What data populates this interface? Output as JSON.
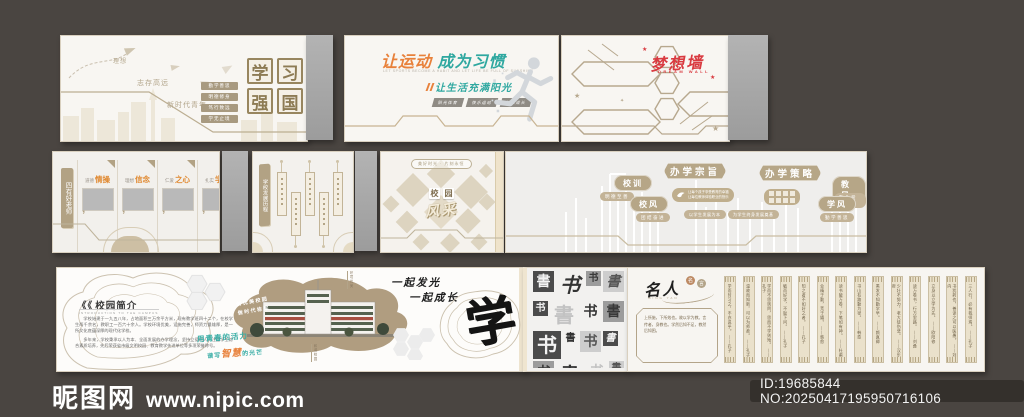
{
  "watermark": {
    "site_name": "昵图网",
    "site_url": "www.nipic.com",
    "id_text": "ID:19685844 NO:20250417195950716106"
  },
  "study": {
    "chars": [
      "学",
      "习",
      "强",
      "国"
    ],
    "label_ideal": "理想",
    "label_motto": "志存高远",
    "label_youth": "新时代青年",
    "tags": [
      "勤学善思",
      "明德修身",
      "笃行致远",
      "学无止境"
    ]
  },
  "sport": {
    "title_orange": "让运动",
    "title_teal": "成为习惯",
    "subtitle_en": "LET SPORTS BECOME A HABIT AND LET LIFE BE FULL OF SUNSHINE",
    "subtitle": "让生活充满阳光",
    "tags": [
      "阳光体育",
      "快乐运动",
      "健康成长"
    ]
  },
  "dream": {
    "title": "梦想墙",
    "subtitle": "DREAM WALL"
  },
  "teachers": {
    "sign": "四有好老师",
    "mark": "’",
    "items": [
      {
        "prefix": "道德",
        "accent": "情操"
      },
      {
        "prefix": "理想",
        "accent": "信念"
      },
      {
        "prefix": "仁爱",
        "accent": "之心"
      },
      {
        "prefix": "扎实",
        "accent": "学识"
      }
    ]
  },
  "history": {
    "sign": "学校发展历程"
  },
  "mosaic": {
    "pill": "美好时光 · 片刻永恒",
    "box1": "校",
    "box2": "园",
    "script": "风采"
  },
  "strategy": {
    "badge1": "办学宗旨",
    "badge2": "办学策略",
    "mission_line1": "让每个孩子享受教育的幸福",
    "mission_line2": "让每位教师体验职业的快乐",
    "pills": [
      "以学生发展为本",
      "为学生终身发展奠基"
    ],
    "ovals": [
      {
        "label": "校训",
        "tag": "明德至善"
      },
      {
        "label": "校风",
        "tag": "团结奋进"
      },
      {
        "label": "教风",
        "tag": "敬业爱生"
      },
      {
        "label": "学风",
        "tag": "勤学善思"
      }
    ]
  },
  "intro": {
    "marks": "《《",
    "heading": "校园简介",
    "heading_en": "INTRODUCTION TO THE CAMPUS",
    "body_p1": "学校始建于一九五八年，占地面积三万余平方米，现有教学班四十二个，在校学生两千余名，教职工一百六十余人。学校环境优美，设施完善，师资力量雄厚，是一所文化底蕴深厚的现代化学校。",
    "body_p2": "多年来，学校秉承以人为本、全面发展的办学理念，坚持立德树人，注重学生综合素质培养，先后荣获省市级文明校园、教育教学先进单位等多项荣誉称号。",
    "blob_line1": "创优美校园",
    "blob_line2": "做时代栋梁",
    "ann1": "环境优美",
    "ann2": "和谐校园",
    "grow1": "一起发光",
    "grow2": "一起成长",
    "slogan1": "用青春的活力",
    "slogan2_pre": "谱写",
    "slogan2_accent": "智慧",
    "slogan2_post": "的光芒",
    "calligraphy": "学"
  },
  "books": {
    "tiles": [
      {
        "c": "書",
        "v": "t-dark",
        "f": "f-serif",
        "s": "s-m"
      },
      {
        "c": "书",
        "v": "t-plain",
        "f": "f-ital",
        "s": "s-l"
      },
      {
        "c": "书",
        "v": "t-mid",
        "f": "f-serif",
        "s": "s-s"
      },
      {
        "c": "書",
        "v": "t-light",
        "f": "f-ital",
        "s": "s-m"
      },
      {
        "c": "书",
        "v": "t-dark",
        "f": "f-sans",
        "s": "s-s"
      },
      {
        "c": "書",
        "v": "t-faint",
        "f": "f-serif",
        "s": "s-l"
      },
      {
        "c": "书",
        "v": "t-plain",
        "f": "f-serif",
        "s": "s-m"
      },
      {
        "c": "書",
        "v": "t-mid",
        "f": "f-serif",
        "s": "s-m"
      },
      {
        "c": "书",
        "v": "t-dark",
        "f": "f-serif",
        "s": "s-l"
      },
      {
        "c": "書",
        "v": "t-plain",
        "f": "f-sans",
        "s": "s-s"
      },
      {
        "c": "书",
        "v": "t-light",
        "f": "f-serif",
        "s": "s-m"
      },
      {
        "c": "書",
        "v": "t-dark",
        "f": "f-ital",
        "s": "s-s"
      },
      {
        "c": "书",
        "v": "t-mid",
        "f": "f-sans",
        "s": "s-m"
      },
      {
        "c": "書",
        "v": "t-plain",
        "f": "f-serif",
        "s": "s-l"
      },
      {
        "c": "书",
        "v": "t-faint",
        "f": "f-serif",
        "s": "s-m"
      },
      {
        "c": "書",
        "v": "t-light",
        "f": "f-sans",
        "s": "s-s"
      },
      {
        "c": "书",
        "v": "t-dark",
        "f": "f-serif",
        "s": "s-m"
      },
      {
        "c": "書",
        "v": "t-plain",
        "f": "f-ital",
        "s": "s-m"
      }
    ]
  },
  "celebrity": {
    "title": "名人",
    "subtitle": "MING YAN",
    "seal1": "名",
    "seal2": "言",
    "quote": "上所施，下所效也。故以学为教。言传者，身教也。学然后知不足，教然后知困。",
    "slats": [
      "学而时习之，不亦说乎。 ——孔子",
      "温故而知新，可以为师矣。 ——孔子",
      "学而不思则罔，思而不学则殆。 ——孔子",
      "敏而好学，不耻下问。 ——孔子",
      "知之者不如好之者。 ——孔子",
      "业精于勤，荒于嬉。 ——韩愈",
      "读书破万卷，下笔如有神。 ——杜甫",
      "书山有路勤为径。 ——韩愈",
      "黑发不知勤学早。 ——颜真卿",
      "少壮不努力，老大徒伤悲。 ——汉乐府",
      "读万卷书，行万里路。 ——刘彝",
      "立身以立学为先。 ——欧阳修",
      "书犹药也，善读之可以医愚。 ——刘向",
      "三人行，必有我师焉。 ——孔子"
    ]
  }
}
